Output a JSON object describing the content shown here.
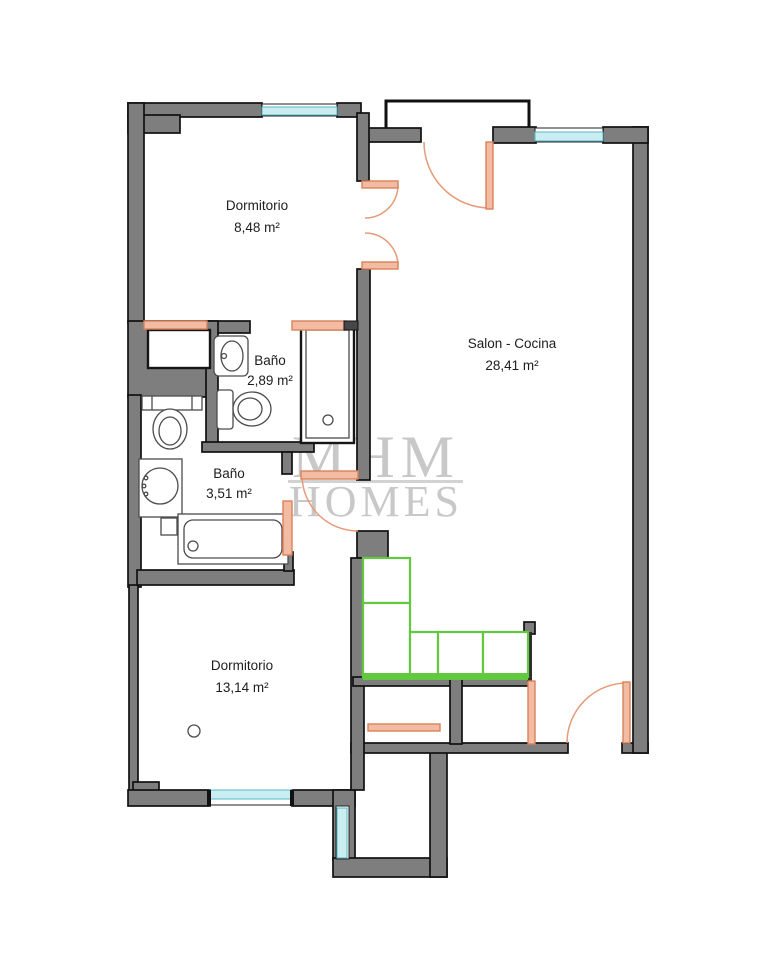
{
  "rooms": [
    {
      "id": "bedroom-1",
      "name": "Dormitorio",
      "area": "8,48 m²"
    },
    {
      "id": "salon-kitchen",
      "name": "Salon - Cocina",
      "area": "28,41 m²"
    },
    {
      "id": "bathroom-1",
      "name": "Baño",
      "area": "2,89 m²"
    },
    {
      "id": "bathroom-2",
      "name": "Baño",
      "area": "3,51 m²"
    },
    {
      "id": "bedroom-2",
      "name": "Dormitorio",
      "area": "13,14 m²"
    }
  ],
  "watermark": {
    "line1": "MHM",
    "line2": "HOMES"
  },
  "colors": {
    "wall": "#7e7e7e",
    "wall_edge": "#111111",
    "window": "#c9edf1",
    "window_edge": "#58b7c3",
    "door": "#f2bba2",
    "door_edge": "#d9825b",
    "door_arc": "#e69b79",
    "counter": "#62c840",
    "watermark": "#c8c8c8",
    "label": "#1d1d1d",
    "landing": "#111111",
    "fixture": "#4c4c4c"
  }
}
